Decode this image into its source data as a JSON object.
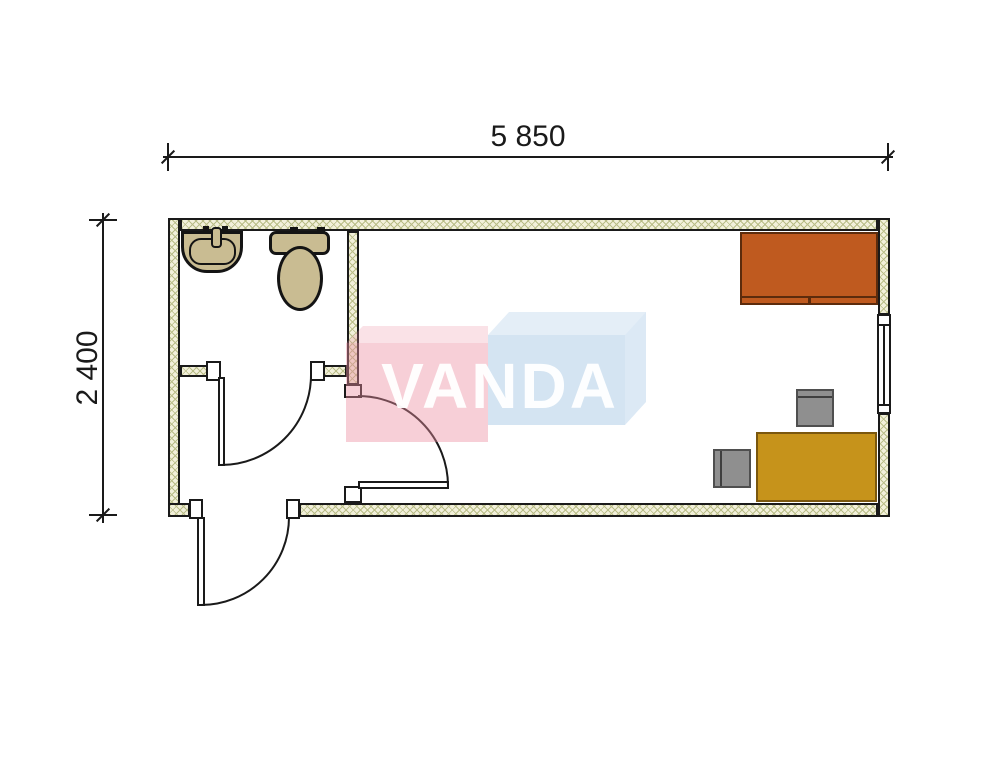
{
  "title": "Container cabin floor plan",
  "dimensions": {
    "width": "5 850",
    "height": "2 400"
  },
  "watermark": {
    "text": "VANDA",
    "pink_block_color": "#F6CED7",
    "blue_block_color": "#D3E3F2",
    "text_color": "#FFFFFF"
  },
  "palette": {
    "outline": "#1A1A1A",
    "wall_fill": "#F2F0DA",
    "wall_hatch": "#B9BD88",
    "fixture_fill": "#C9BC92",
    "bed_fill": "#BF5A1F",
    "desk_fill": "#C6931B",
    "chair_fill": "#8F8F8F"
  },
  "fixtures": {
    "bathroom": [
      "sink",
      "toilet"
    ],
    "main_room": [
      "bed",
      "desk",
      "chair",
      "chair",
      "window"
    ],
    "doors": [
      "bathroom-door",
      "main-room-door",
      "entrance-door"
    ]
  }
}
